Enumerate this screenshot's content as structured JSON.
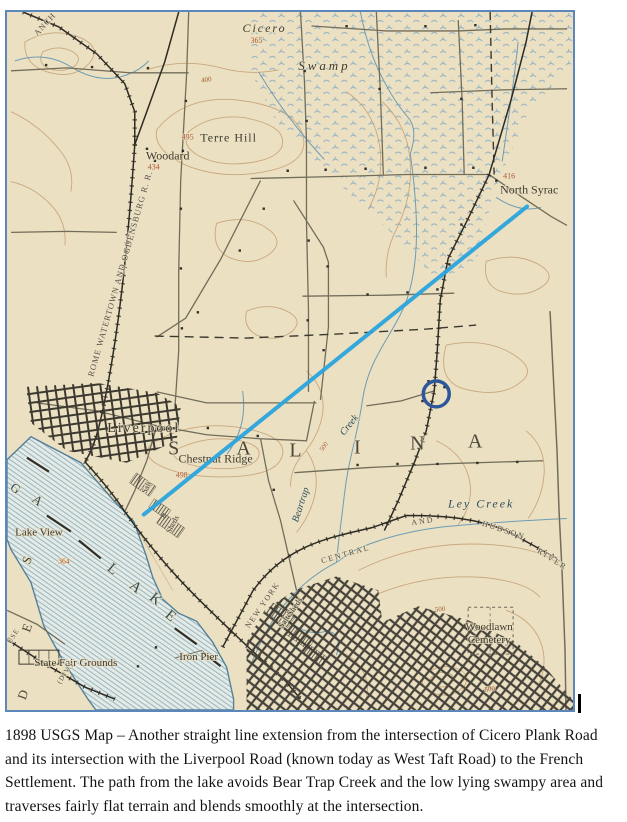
{
  "map": {
    "frame_color": "#5b87bb",
    "paper_color": "#ece0c2",
    "annotations": {
      "route_line": {
        "x1": 521,
        "y1": 195,
        "x2": 137,
        "y2": 504,
        "color": "#2ba5de",
        "width": 4
      },
      "highlight_circle": {
        "cx": 430,
        "cy": 383,
        "r": 13,
        "color": "#2e579b",
        "width": 3.5
      }
    },
    "label_colors": {
      "ink": "#3e3a2f",
      "water": "#2e4d5c",
      "elev": "#a85a32",
      "rr": "#55514a",
      "big": "#4a463a"
    },
    "labels": [
      {
        "id": "cicero",
        "t": "Cicero",
        "x": 258,
        "y": 20,
        "s": 12,
        "i": 1,
        "ls": 2,
        "c": "ink"
      },
      {
        "id": "elev-365",
        "t": "365",
        "x": 250,
        "y": 31,
        "s": 8,
        "c": "elev"
      },
      {
        "id": "swamp",
        "t": "Swamp",
        "x": 318,
        "y": 58,
        "s": 13,
        "i": 1,
        "ls": 3,
        "c": "ink"
      },
      {
        "id": "elev-400",
        "t": "400",
        "x": 200,
        "y": 70,
        "s": 7,
        "r": -8,
        "c": "elev"
      },
      {
        "id": "terre-hill",
        "t": "Terre Hill",
        "x": 222,
        "y": 130,
        "s": 12,
        "ls": 1,
        "c": "ink"
      },
      {
        "id": "elev-495",
        "t": "495",
        "x": 181,
        "y": 128,
        "s": 8,
        "c": "elev"
      },
      {
        "id": "woodard",
        "t": "Woodard",
        "x": 161,
        "y": 148,
        "s": 12,
        "c": "ink"
      },
      {
        "id": "elev-434",
        "t": "434",
        "x": 147,
        "y": 158,
        "s": 8,
        "c": "elev"
      },
      {
        "id": "north-syracuse",
        "t": "North Syrac",
        "x": 494,
        "y": 182,
        "s": 12,
        "a": "start",
        "c": "ink"
      },
      {
        "id": "elev-416",
        "t": "416",
        "x": 503,
        "y": 167,
        "s": 8,
        "c": "elev"
      },
      {
        "id": "liverpool",
        "t": "Liverpool",
        "x": 137,
        "y": 421,
        "s": 14,
        "ls": 2,
        "c": "ink"
      },
      {
        "id": "chestnut-ridge",
        "t": "Chestnut Ridge",
        "x": 209,
        "y": 452,
        "s": 12,
        "c": "ink"
      },
      {
        "id": "elev-498",
        "t": "498",
        "x": 175,
        "y": 467,
        "s": 8,
        "c": "elev"
      },
      {
        "id": "salina-s",
        "t": "S",
        "x": 167,
        "y": 444,
        "s": 20,
        "c": "big"
      },
      {
        "id": "salina-a1",
        "t": "A",
        "x": 237,
        "y": 444,
        "s": 20,
        "c": "big"
      },
      {
        "id": "salina-l",
        "t": "L",
        "x": 289,
        "y": 446,
        "s": 20,
        "c": "big"
      },
      {
        "id": "salina-i",
        "t": "I",
        "x": 351,
        "y": 443,
        "s": 20,
        "c": "big"
      },
      {
        "id": "salina-n",
        "t": "N",
        "x": 411,
        "y": 439,
        "s": 20,
        "c": "big"
      },
      {
        "id": "salina-a2",
        "t": "A",
        "x": 469,
        "y": 437,
        "s": 20,
        "c": "big"
      },
      {
        "id": "beartrap",
        "t": "Beartrap",
        "x": 297,
        "y": 495,
        "s": 10,
        "i": 1,
        "r": -72,
        "c": "water"
      },
      {
        "id": "beartrap-creek",
        "t": "Creek",
        "x": 345,
        "y": 416,
        "s": 10,
        "i": 1,
        "r": -52,
        "c": "water"
      },
      {
        "id": "elev-500-creek",
        "t": "500",
        "x": 319,
        "y": 437,
        "s": 6.5,
        "r": -55,
        "c": "elev"
      },
      {
        "id": "ley-creek",
        "t": "Ley Creek",
        "x": 475,
        "y": 497,
        "s": 12,
        "i": 1,
        "ls": 2,
        "c": "water"
      },
      {
        "id": "lake-view",
        "t": "Lake View",
        "x": 32,
        "y": 525,
        "s": 11,
        "c": "ink"
      },
      {
        "id": "elev-364",
        "t": "364",
        "x": 57,
        "y": 553,
        "s": 7.5,
        "c": "elev"
      },
      {
        "id": "state-fair-grounds",
        "t": "State Fair Grounds",
        "x": 69,
        "y": 656,
        "s": 11,
        "c": "ink"
      },
      {
        "id": "iron-pier",
        "t": "Iron Pier",
        "x": 192,
        "y": 650,
        "s": 11,
        "c": "ink"
      },
      {
        "id": "woodlawn",
        "t": "Woodlawn",
        "x": 483,
        "y": 620,
        "s": 11,
        "c": "ink"
      },
      {
        "id": "cemetery",
        "t": "Cemetery",
        "x": 483,
        "y": 633,
        "s": 11,
        "c": "ink"
      },
      {
        "id": "elev-500-a",
        "t": "500",
        "x": 434,
        "y": 601,
        "s": 7,
        "r": -5,
        "c": "elev"
      },
      {
        "id": "elev-500-b",
        "t": "500",
        "x": 484,
        "y": 681,
        "s": 7,
        "r": -10,
        "c": "elev"
      },
      {
        "id": "rr-new-york",
        "t": "NEW YORK",
        "x": 258,
        "y": 596,
        "s": 8,
        "r": -55,
        "ls": 1.5,
        "c": "rr"
      },
      {
        "id": "rr-central",
        "t": "CENTRAL",
        "x": 340,
        "y": 546,
        "s": 8,
        "r": -16,
        "ls": 2,
        "c": "rr"
      },
      {
        "id": "rr-and",
        "t": "AND",
        "x": 417,
        "y": 513,
        "s": 8,
        "r": -8,
        "ls": 2,
        "c": "rr"
      },
      {
        "id": "rr-hudson",
        "t": "HUDSON",
        "x": 497,
        "y": 522,
        "s": 8,
        "r": 18,
        "ls": 2,
        "c": "rr"
      },
      {
        "id": "rr-river",
        "t": "RIVER",
        "x": 545,
        "y": 551,
        "s": 8,
        "r": 32,
        "ls": 2,
        "c": "rr"
      },
      {
        "id": "salt-sheds-syracuse",
        "t": "Salt Sheds",
        "x": 286,
        "y": 604,
        "s": 8.5,
        "r": -55,
        "c": "ink"
      },
      {
        "id": "salt-liverpool",
        "t": "Salt",
        "x": 142,
        "y": 478,
        "s": 8,
        "r": -62,
        "c": "ink"
      },
      {
        "id": "sheds-liverpool",
        "t": "Sheds",
        "x": 168,
        "y": 515,
        "s": 8,
        "r": -62,
        "c": "ink"
      },
      {
        "id": "rr-ogdensburg",
        "t": "ROME WATERTOWN AND OGDENSBURG R. R.",
        "x": 116,
        "y": 263,
        "s": 8.5,
        "r": -74,
        "ls": 1,
        "c": "rr"
      },
      {
        "id": "rr-branch",
        "t": "ANCH",
        "x": 40,
        "y": 14,
        "s": 8.5,
        "r": -48,
        "ls": 1,
        "c": "rr"
      },
      {
        "id": "rr-div",
        "t": "(DIV.)",
        "x": 60,
        "y": 664,
        "s": 7,
        "r": -58,
        "ls": 1,
        "c": "rr"
      },
      {
        "id": "rr-use",
        "t": "USE",
        "x": 8,
        "y": 627,
        "s": 7,
        "r": -58,
        "ls": 1,
        "c": "rr"
      },
      {
        "id": "lake-g",
        "t": "G",
        "x": 6,
        "y": 481,
        "s": 13,
        "r": 38,
        "c": "water"
      },
      {
        "id": "lake-a0",
        "t": "A",
        "x": 28,
        "y": 493,
        "s": 13,
        "r": 38,
        "c": "water"
      },
      {
        "id": "lake-l",
        "t": "L",
        "x": 103,
        "y": 562,
        "s": 15,
        "r": 40,
        "c": "water"
      },
      {
        "id": "lake-a1",
        "t": "A",
        "x": 126,
        "y": 580,
        "s": 15,
        "r": 40,
        "c": "water"
      },
      {
        "id": "lake-k",
        "t": "K",
        "x": 146,
        "y": 592,
        "s": 15,
        "r": 40,
        "c": "water"
      },
      {
        "id": "lake-e",
        "t": "E",
        "x": 161,
        "y": 609,
        "s": 15,
        "r": 40,
        "c": "water"
      },
      {
        "id": "geddes-s",
        "t": "S",
        "x": 24,
        "y": 551,
        "s": 13,
        "r": -70,
        "c": "big"
      },
      {
        "id": "geddes-e",
        "t": "E",
        "x": 24,
        "y": 619,
        "s": 13,
        "r": -70,
        "c": "big"
      },
      {
        "id": "geddes-d",
        "t": "D",
        "x": 20,
        "y": 686,
        "s": 13,
        "r": -70,
        "c": "big"
      }
    ]
  },
  "caption": {
    "text": "1898 USGS Map – Another straight line extension from the intersection of Cicero Plank Road and its intersection with the Liverpool Road (known today as West Taft Road) to the French Settlement. The path from the lake avoids Bear Trap Creek and the low lying swampy area and traverses fairly flat terrain and blends smoothly at the intersection."
  }
}
